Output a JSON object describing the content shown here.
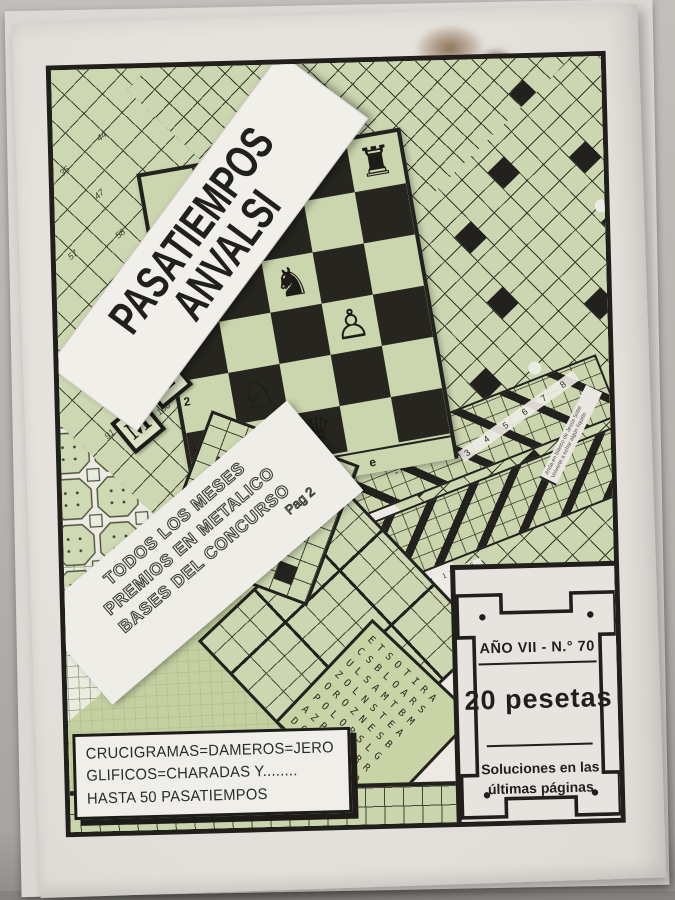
{
  "cover": {
    "title": {
      "line1": "PASATIEMPOS",
      "line2": "ANVALSI"
    },
    "promo": {
      "line1": "TODOS LOS MESES",
      "line2": "PREMIOS EN METALICO",
      "line3": "BASES DEL CONCURSO",
      "page": "Pag 2"
    },
    "contents": {
      "line1": "CRUCIGRAMAS=DAMEROS=JERO",
      "line2": "GLIFICOS=CHARADAS Y........",
      "line3": "HASTA 50 PASATIEMPOS"
    },
    "badge": {
      "issue": "AÑO VII - N.° 70",
      "price": "20 pesetas",
      "note1": "Soluciones en las",
      "note2": "últimas páginas"
    },
    "labels": {
      "silabico": "- SILABICO -",
      "edge_numbers_a": "3 4 5 6 7 8",
      "edge_numbers_b": "9 10 11 12 13 14 15 16",
      "clue1": "Anda en blanco de Jesús Sotel",
      "clue2": "Volverte a echar algún líquido"
    },
    "letter_tiles": {
      "t": "T",
      "m": "M",
      "z": "Z"
    },
    "chess": {
      "files": "a b c d e",
      "rank2": "2",
      "rank1": "1",
      "pieces": [
        {
          "glyph": "♜"
        },
        {
          "glyph": "♞"
        },
        {
          "glyph": "♙"
        },
        {
          "glyph": "♘"
        },
        {
          "glyph": "♛"
        }
      ]
    },
    "damero_numbers": [
      {
        "t": "35",
        "x": 6,
        "y": 96
      },
      {
        "t": "44",
        "x": 44,
        "y": 62
      },
      {
        "t": "47",
        "x": 40,
        "y": 120
      },
      {
        "t": "57",
        "x": 12,
        "y": 180
      },
      {
        "t": "58",
        "x": 60,
        "y": 160
      },
      {
        "t": "60",
        "x": 104,
        "y": 128
      },
      {
        "t": "61",
        "x": 150,
        "y": 96
      },
      {
        "t": "65",
        "x": 196,
        "y": 64
      },
      {
        "t": "69",
        "x": 64,
        "y": 230
      },
      {
        "t": "71",
        "x": 110,
        "y": 196
      },
      {
        "t": "73",
        "x": 226,
        "y": 30
      },
      {
        "t": "75",
        "x": 156,
        "y": 164
      },
      {
        "t": "76",
        "x": 244,
        "y": 98
      },
      {
        "t": "80",
        "x": 58,
        "y": 300
      },
      {
        "t": "81",
        "x": 104,
        "y": 266
      },
      {
        "t": "83",
        "x": 200,
        "y": 132
      },
      {
        "t": "84",
        "x": 288,
        "y": 66
      },
      {
        "t": "87",
        "x": 332,
        "y": 34
      },
      {
        "t": "91",
        "x": 44,
        "y": 360
      },
      {
        "t": "94",
        "x": 150,
        "y": 232
      },
      {
        "t": "96",
        "x": 246,
        "y": 166
      },
      {
        "t": "98",
        "x": 196,
        "y": 200
      },
      {
        "t": "99",
        "x": 292,
        "y": 134
      },
      {
        "t": "101",
        "x": 240,
        "y": 236
      },
      {
        "t": "103",
        "x": 338,
        "y": 100
      },
      {
        "t": "106",
        "x": 96,
        "y": 336
      },
      {
        "t": "107",
        "x": 142,
        "y": 302
      },
      {
        "t": "110",
        "x": 384,
        "y": 70
      },
      {
        "t": "111",
        "x": 334,
        "y": 168
      },
      {
        "t": "113",
        "x": 286,
        "y": 202
      },
      {
        "t": "116",
        "x": 380,
        "y": 136
      },
      {
        "t": "119",
        "x": 408,
        "y": 38
      }
    ],
    "wordsearch": {
      "rows": [
        "ETSOTIRA",
        "CSBLOARS",
        "ULSAMTBM",
        "ZOLNSTEA",
        "OROZNESB",
        "POLORSLG",
        "AZPACLRR",
        "DOPMZIAO"
      ]
    }
  },
  "colors": {
    "paper": "#e7e3de",
    "green": "#ccd6b0",
    "ink": "#201f1b"
  }
}
